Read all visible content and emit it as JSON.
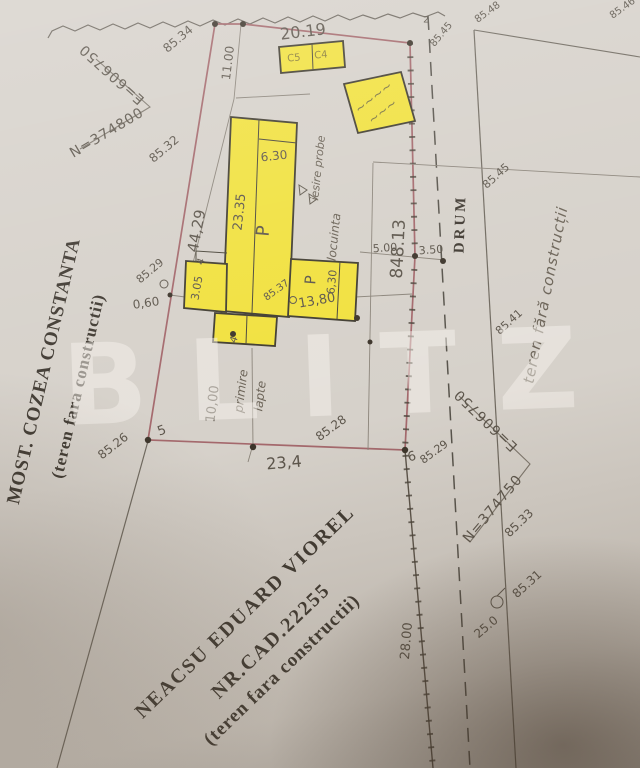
{
  "watermark": "BLITZ",
  "owners": {
    "left_name": "MOST. COZEA CONSTANTA",
    "left_note": "(teren fara constructii)",
    "bottom_name": "NEACSU EDUARD VIOREL",
    "bottom_cad": "NR.CAD.22255",
    "bottom_note": "(teren fara constructii)"
  },
  "road": {
    "name": "DRUM",
    "right_note": "teren fără construcții"
  },
  "grid": {
    "cross_a_n": "N=374800",
    "cross_a_e": "E=606750",
    "cross_b_n": "N=374750",
    "cross_b_e": "E=606750"
  },
  "house": {
    "level_main": "P",
    "level_wing": "P",
    "use_label": "locuinta",
    "exit_label": "iesire probe",
    "milk_line1": "primire",
    "milk_line2": "lapte",
    "cell_left": "C5",
    "cell_right": "C4",
    "shed_text1": "~~~~",
    "shed_text2": "~~~"
  },
  "dims": {
    "top_edge": "20.19",
    "offset_north": "11.00",
    "west_line": "44,29",
    "house_length": "23.35",
    "house_width": "6.30",
    "annex_depth": "3.05",
    "gap_west": "0,60",
    "wing_length": "13,80",
    "wing_width": "6,30",
    "milk_offset": "10,00",
    "bottom_edge": "23,4",
    "road_frontage": "28.00",
    "strip_width": "5.00",
    "half_road": "3.50",
    "area": "848.13",
    "pole": "25.0"
  },
  "elev": {
    "e1": "85.34",
    "e2": "85.32",
    "e3": "85.29",
    "e4": "85.26",
    "e5": "85.28",
    "e6": "85.29",
    "e7": "85.45",
    "e8": "85.48",
    "e9": "85.46",
    "e10": "85.45",
    "e11": "85.41",
    "e12": "85.33",
    "e13": "85.31",
    "e14": "85.37"
  },
  "points": {
    "p2": "2",
    "p5": "5",
    "p6": "6",
    "p4a": "4",
    "p4b": "4"
  }
}
